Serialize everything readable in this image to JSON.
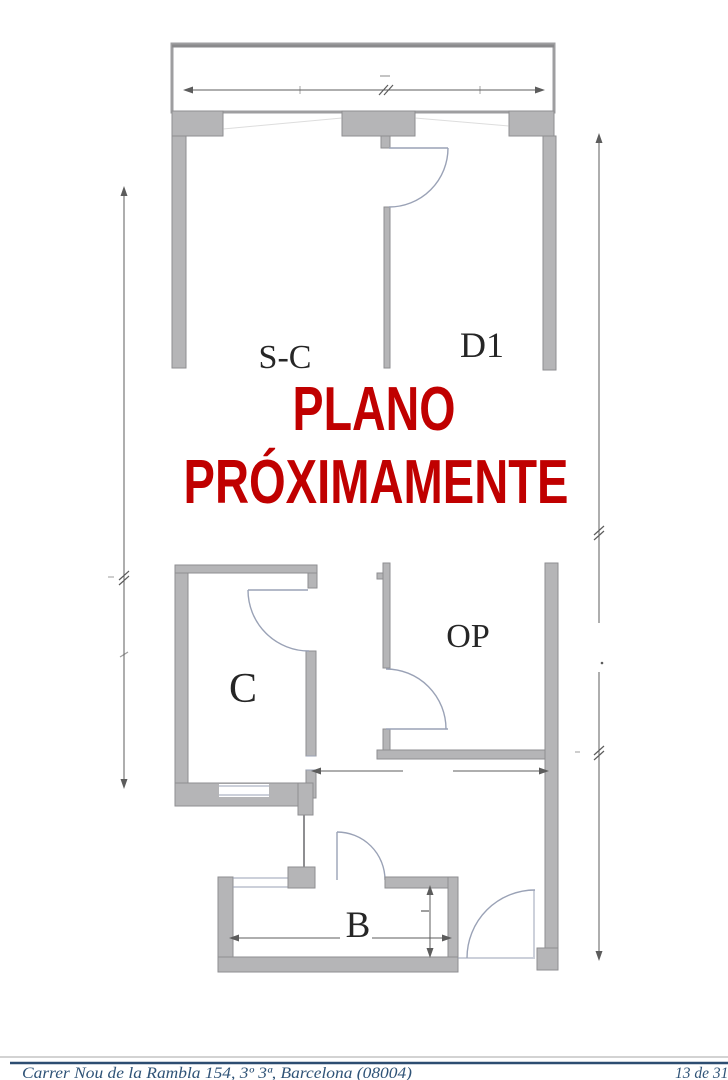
{
  "document": {
    "watermark": {
      "line1": "PLANO",
      "line2": "PRÓXIMAMENTE",
      "color": "#c00000"
    },
    "footer": {
      "address": "Carrer Nou de la Rambla 154, 3º 3ª, Barcelona (08004)",
      "page_indicator": "13 de 31",
      "rule_color": "#2d4d71",
      "text_color": "#2f5377"
    }
  },
  "floor_plan": {
    "room_labels": {
      "sc": "S-C",
      "d1": "D1",
      "c": "C",
      "op": "OP",
      "b": "B"
    },
    "colors": {
      "wall_fill": "#b5b5b7",
      "wall_outline": "#8e8e91",
      "door_line": "#9aa2b6",
      "dimension_line": "#5c5c5c",
      "label_color": "#262626"
    }
  }
}
